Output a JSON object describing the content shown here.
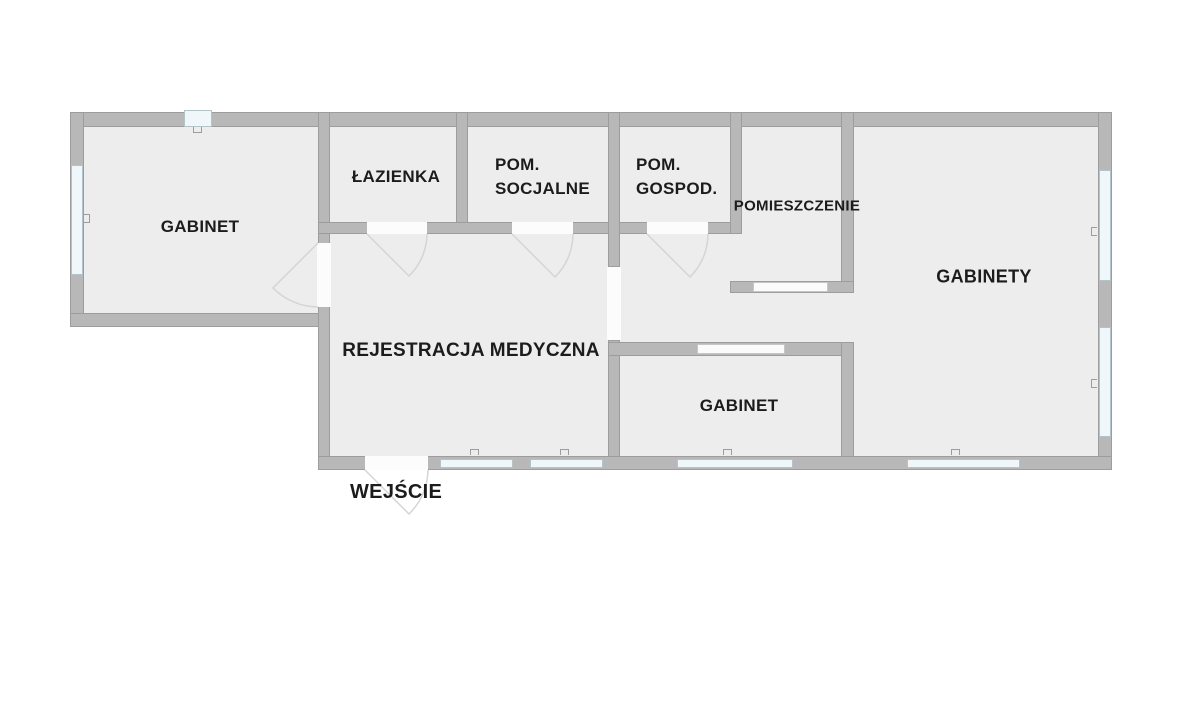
{
  "palette": {
    "wall": "#b8b8b8",
    "wall_edge": "#9d9d9d",
    "floor": "#ededed",
    "window_fill": "#f0f7fa",
    "window_edge": "#b4c3c9",
    "door_arc": "#d5d5d5",
    "text": "#1c1c1c",
    "background": "#ffffff"
  },
  "rooms": {
    "gabinet_top_left": {
      "label": "GABINET"
    },
    "lazienka": {
      "label": "ŁAZIENKA"
    },
    "pom_socjalne": {
      "line1": "POM.",
      "line2": "SOCJALNE"
    },
    "pom_gospod": {
      "line1": "POM.",
      "line2": "GOSPOD."
    },
    "pomieszczenie": {
      "label": "POMIESZCZENIE"
    },
    "gabinety": {
      "label": "GABINETY"
    },
    "rejestracja": {
      "label": "REJESTRACJA MEDYCZNA"
    },
    "gabinet_bottom": {
      "label": "GABINET"
    }
  },
  "annotations": {
    "entrance": {
      "label": "WEJŚCIE"
    }
  }
}
